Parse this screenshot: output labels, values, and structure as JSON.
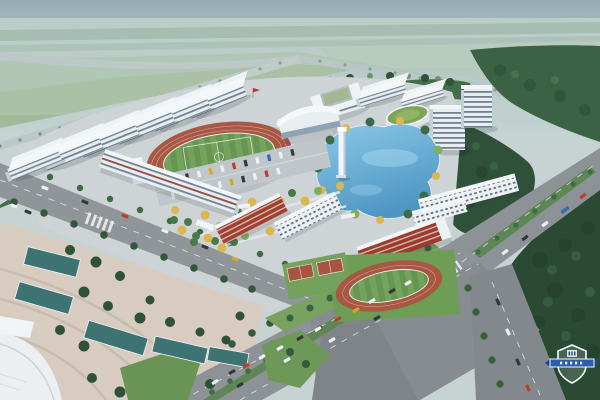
{
  "meta": {
    "description": "Bird's-eye architectural rendering of a school campus master plan",
    "view": "aerial perspective, hazy daylight"
  },
  "palette": {
    "sky_top": "#879fab",
    "sky_haze": "#c6d5d2",
    "far_plain": "#b7cac6",
    "field_green_far": "#a9c2ae",
    "meadow": "#9db893",
    "highway_grey": "#bcc8c7",
    "mid_trees": "#436c49",
    "dark_forest": "#2a4a34",
    "campus_ground": "#ced4d6",
    "plaza_paving": "#d8ccc1",
    "building_white": "#f3f6f8",
    "building_window": "#70828f",
    "building_red": "#9e3a2b",
    "track_red": "#a85743",
    "infield_green": "#74a45c",
    "court_green": "#74a15c",
    "lake_blue_light": "#8cc8e8",
    "lake_blue_deep": "#4e97c4",
    "pool_teal": "#3d7372",
    "road_asphalt": "#8d9296",
    "road_dark": "#7f8488",
    "median_green": "#5e8656",
    "lawn_green": "#6a9455",
    "tree_green": "#3e6b47",
    "tree_light": "#7fae62",
    "tree_yellow": "#d9b84f",
    "car_white": "#eef1f2",
    "car_dark": "#33383d",
    "car_red": "#c23b2e",
    "car_yellow": "#d9a623",
    "car_blue": "#3a6ab0",
    "watermark_banner": "#2d5caa",
    "watermark_outline": "#f5f8fa"
  },
  "scene": {
    "sky": {
      "label": "hazy sky over distant plain"
    },
    "highway": {
      "label": "distant tree-lined highway crossing the plain"
    },
    "campus": {
      "dorm_row": {
        "label": "echelon row of white slab buildings",
        "count": 6
      },
      "north_cluster": {
        "label": "courtyard block, slabs, green-roof hall, two towers"
      },
      "gymnasium": {
        "label": "white gymnasium with curved roof"
      },
      "main_stadium": {
        "label": "running track with striped football field"
      },
      "practice_stadium": {
        "label": "small practice running track"
      },
      "basketball_courts": {
        "label": "two outdoor courts"
      },
      "lake": {
        "label": "landscape lake"
      },
      "tower": {
        "label": "white landmark tower by the lake"
      },
      "teaching_complex": {
        "label": "zig-zag teaching buildings with red accents"
      },
      "parking": {
        "label": "tree-lined parking rows with cars"
      },
      "garden": {
        "label": "central garden with yellow and green trees"
      }
    },
    "roads": {
      "avenue": {
        "label": "main avenue with green median and traffic"
      },
      "northwest_road": {
        "label": "road along north-west campus edge"
      },
      "south_branch": {
        "label": "branch road to bottom edge"
      }
    },
    "plaza": {
      "label": "south-west civic plaza with terraced reflecting pools"
    },
    "forest": {
      "label": "dense woodland along the south-east"
    }
  },
  "watermark": {
    "type": "shield-badge",
    "position": "bottom-right",
    "banner_color": "#2d5caa",
    "outline_color": "#f5f8fa",
    "text_legible": false
  }
}
